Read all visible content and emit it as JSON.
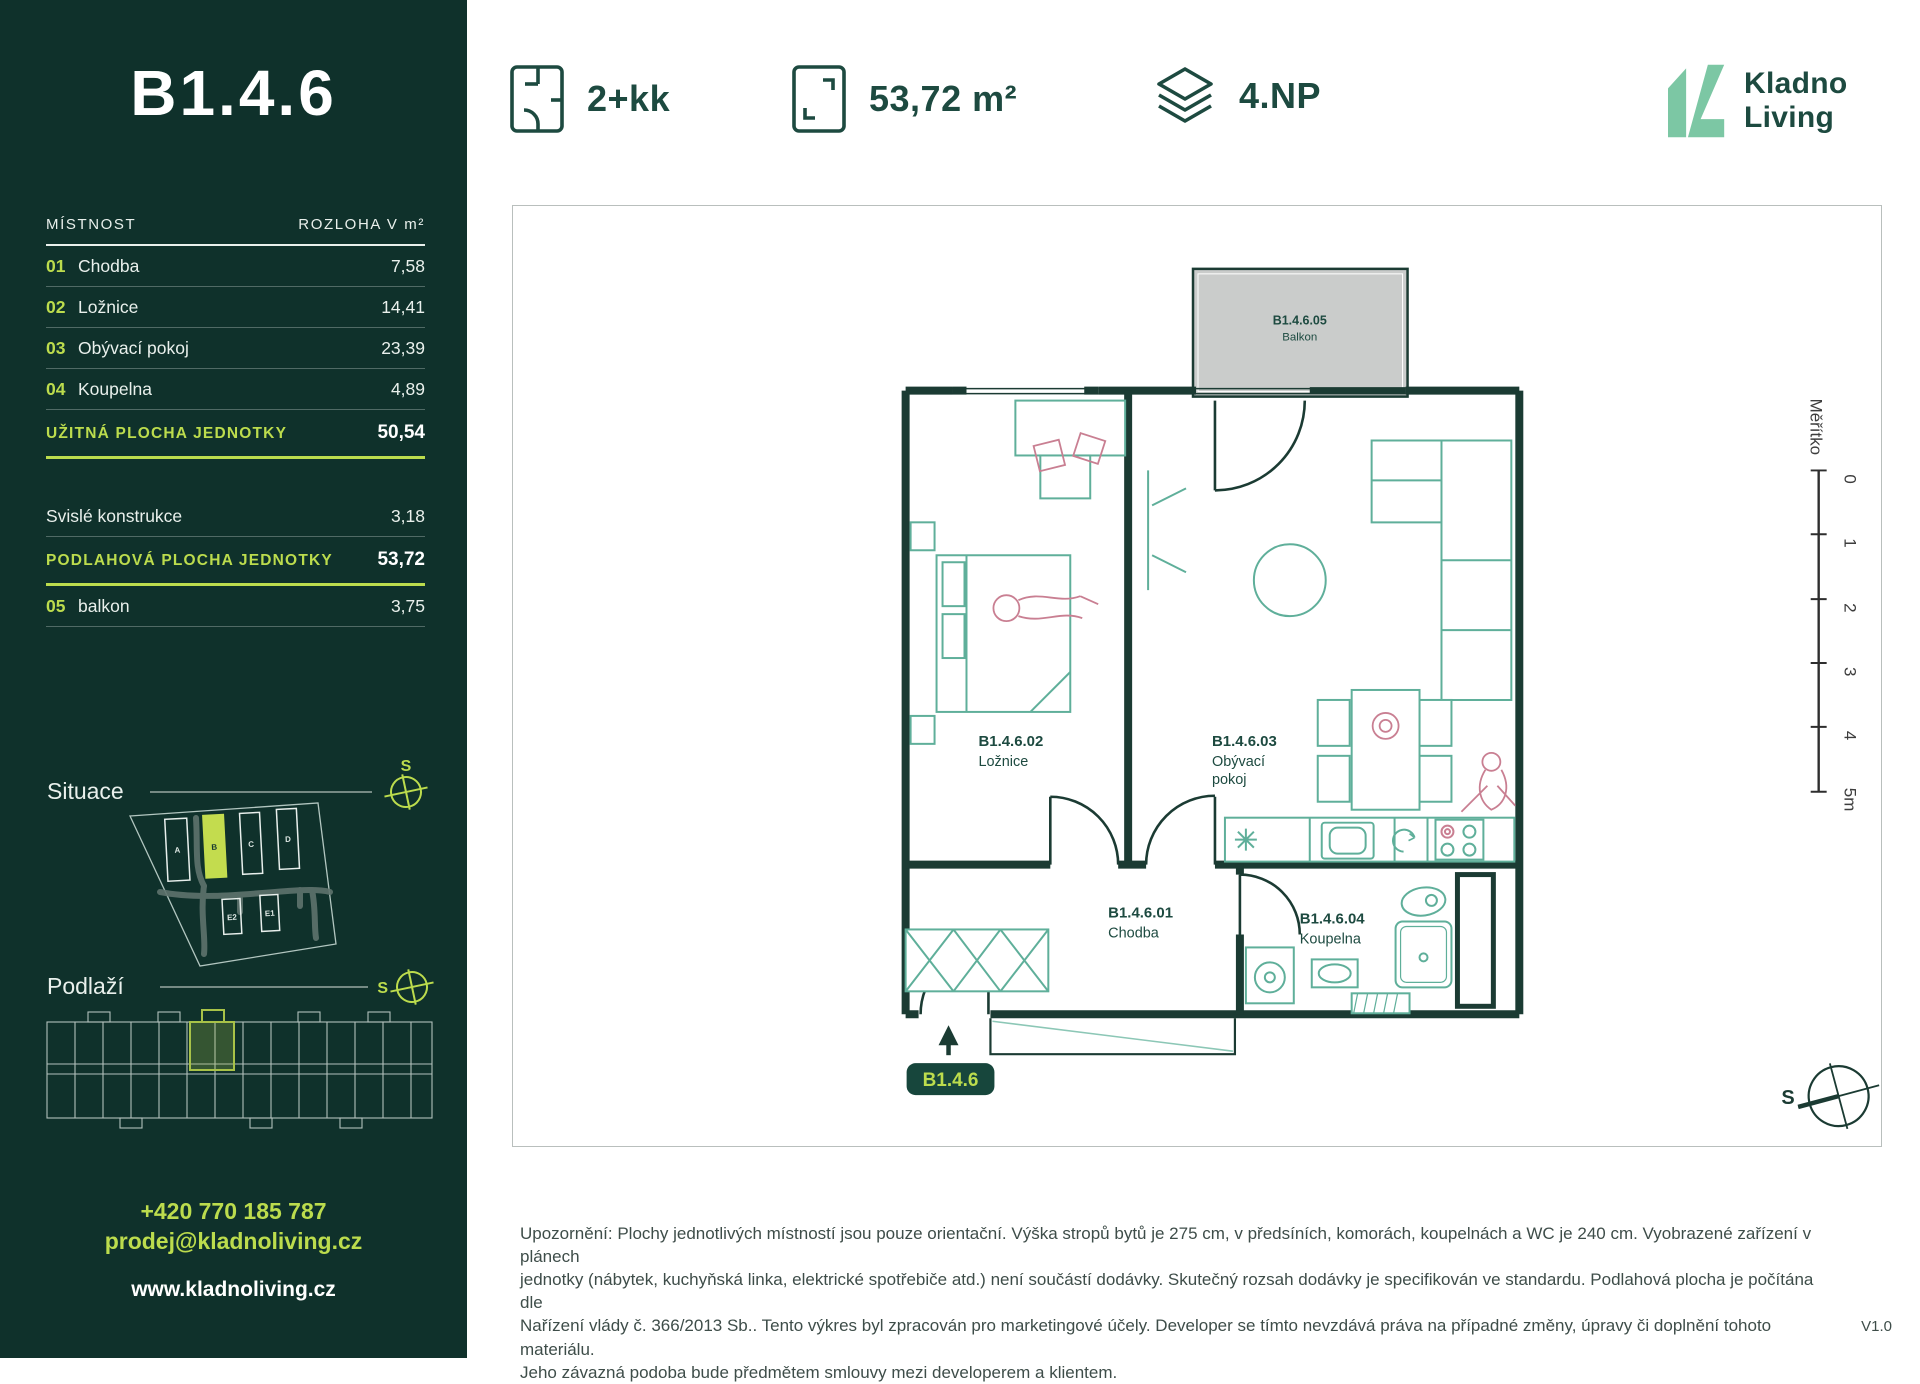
{
  "header": {
    "disposition_label": "2+kk",
    "area_label": "53,72 m²",
    "floor_label": "4.NP",
    "logo": {
      "line1": "Kladno",
      "line2": "Living"
    }
  },
  "sidebar": {
    "unit_title": "B1.4.6",
    "table": {
      "col_room": "MÍSTNOST",
      "col_area": "ROZLOHA V m²",
      "rows": [
        {
          "num": "01",
          "name": "Chodba",
          "value": "7,58"
        },
        {
          "num": "02",
          "name": "Ložnice",
          "value": "14,41"
        },
        {
          "num": "03",
          "name": "Obývací pokoj",
          "value": "23,39"
        },
        {
          "num": "04",
          "name": "Koupelna",
          "value": "4,89"
        }
      ],
      "usable_label": "UŽITNÁ PLOCHA JEDNOTKY",
      "usable_value": "50,54",
      "vertical_label": "Svislé konstrukce",
      "vertical_value": "3,18",
      "floor_area_label": "PODLAHOVÁ PLOCHA JEDNOTKY",
      "floor_area_value": "53,72",
      "balcony_row": {
        "num": "05",
        "name": "balkon",
        "value": "3,75"
      }
    },
    "situace": {
      "label": "Situace",
      "compass_letter": "S",
      "buildings": [
        "A",
        "B",
        "C",
        "D",
        "E2",
        "E1"
      ],
      "highlighted_building": "B"
    },
    "podlazi": {
      "label": "Podlaží",
      "compass_letter": "S"
    },
    "contact": {
      "phone": "+420 770 185 787",
      "email": "prodej@kladnoliving.cz",
      "web": "www.kladnoliving.cz"
    }
  },
  "plan": {
    "rooms": {
      "loznice": {
        "code": "B1.4.6.02",
        "name": "Ložnice"
      },
      "obyvaci": {
        "code": "B1.4.6.03",
        "name_line1": "Obývací",
        "name_line2": "pokoj"
      },
      "chodba": {
        "code": "B1.4.6.01",
        "name": "Chodba"
      },
      "koupelna": {
        "code": "B1.4.6.04",
        "name": "Koupelna"
      },
      "balkon": {
        "code": "B1.4.6.05",
        "name": "Balkon"
      }
    },
    "unit_badge": "B1.4.6",
    "scale": {
      "title": "Měřítko",
      "ticks": [
        "0",
        "1",
        "2",
        "3",
        "4",
        "5m"
      ]
    },
    "compass_letter": "S"
  },
  "footer": {
    "disclaimer_lines": [
      "Upozornění: Plochy jednotlivých místností jsou pouze orientační. Výška stropů bytů je 275 cm, v předsíních, komorách, koupelnách a WC je 240 cm. Vyobrazené zařízení v plánech",
      "jednotky (nábytek, kuchyňská linka, elektrické spotřebiče atd.) není součástí dodávky. Skutečný rozsah dodávky je specifikován ve standardu. Podlahová plocha je počítána dle",
      "Nařízení vlády č. 366/2013 Sb.. Tento výkres byl zpracován pro marketingové účely. Developer se tímto nevzdává práva na případné změny, úpravy či doplnění tohoto materiálu.",
      "Jeho závazná podoba bude předmětem smlouvy mezi developerem a klientem."
    ],
    "version": "V1.0"
  },
  "colors": {
    "sidebar_bg": "#0F312B",
    "accent_lime": "#BCDC4D",
    "logo_mint": "#7CC7A4",
    "dark_green_text": "#1D4A40",
    "wall": "#1B3B33",
    "furniture_teal": "#5FAF9A",
    "figure_pink": "#C97F92",
    "balcony_gray": "#CACCCB"
  }
}
